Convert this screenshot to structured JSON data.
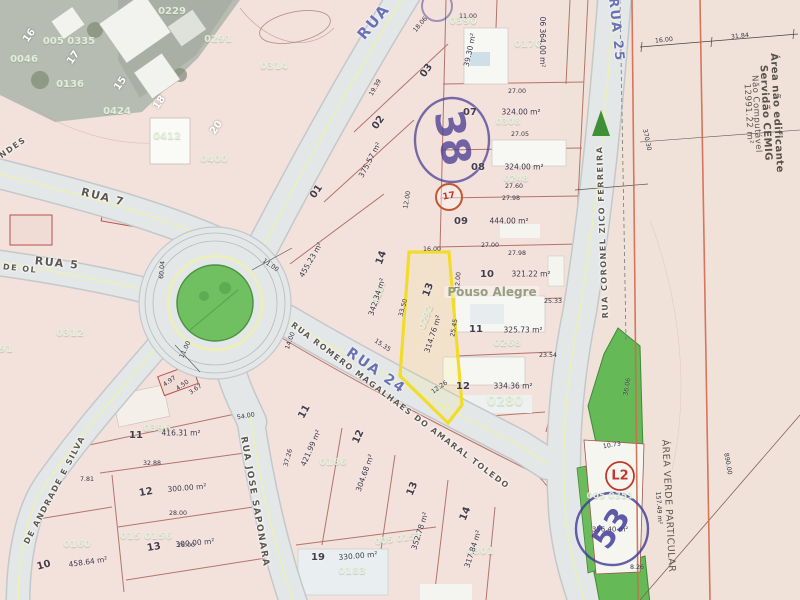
{
  "map": {
    "highlighted_lot": "13",
    "highlighted_lot_area": "314.76 m²",
    "colors": {
      "parcel_pink": "#f3e1dc",
      "street_gray": "#e4e7e8",
      "green_area": "#6cbb5d",
      "boundary_red": "#a25a50",
      "highlight_yellow": "#f2dc2a",
      "stamp_purple": "#4b3f94",
      "stamp_red": "#c0392b",
      "cemig_line_orange": "#d4694f",
      "street_blue_label": "#6872b5"
    },
    "texts": [
      {
        "n": "street-label-rua",
        "t": "RUA",
        "x": 374,
        "y": 22,
        "r": -50,
        "c": "bluestreet",
        "s": 15
      },
      {
        "n": "street-label-rua-7",
        "t": "RUA 7",
        "x": 103,
        "y": 197,
        "r": 14,
        "c": "street",
        "s": 11
      },
      {
        "n": "street-label-rua-5",
        "t": "RUA 5",
        "x": 57,
        "y": 263,
        "r": 6,
        "c": "street",
        "s": 11
      },
      {
        "n": "street-label-de-ol",
        "t": "DE OL",
        "x": 20,
        "y": 269,
        "r": 6,
        "c": "street",
        "s": 8
      },
      {
        "n": "street-label-rua-24",
        "t": "RUA 24",
        "x": 376,
        "y": 371,
        "r": 35,
        "c": "bluestreet",
        "s": 14
      },
      {
        "n": "street-label-romero-magalhaes",
        "t": "RUA ROMERO MAGALHAES DO AMARAL TOLEDO",
        "x": 400,
        "y": 406,
        "r": 37,
        "c": "street",
        "s": 8
      },
      {
        "n": "street-label-jose-saponara",
        "t": "RUA JOSE SAPONARA",
        "x": 254,
        "y": 502,
        "r": 80,
        "c": "street",
        "s": 9
      },
      {
        "n": "street-label-rua-25",
        "t": "RUA 25",
        "x": 616,
        "y": 30,
        "r": 84,
        "c": "bluestreet",
        "s": 13
      },
      {
        "n": "street-label-zico-ferreira",
        "t": "RUA CORONEL ZICO FERREIRA",
        "x": 603,
        "y": 232,
        "r": -92,
        "c": "street",
        "s": 8
      },
      {
        "n": "street-label-andrade-silva",
        "t": "DE ANDRADE E SILVA",
        "x": 55,
        "y": 490,
        "r": -62,
        "c": "street",
        "s": 8
      },
      {
        "n": "street-label-ndes",
        "t": "NDES",
        "x": 13,
        "y": 148,
        "r": -35,
        "c": "street",
        "s": 8
      },
      {
        "n": "cemig-note-line1",
        "t": "Área não edificante",
        "x": 776,
        "y": 113,
        "r": 87,
        "c": "cemig",
        "s": 10
      },
      {
        "n": "cemig-note-line2",
        "t": "Servidão CEMIG",
        "x": 765,
        "y": 113,
        "r": 87,
        "c": "cemig",
        "s": 10
      },
      {
        "n": "cemig-note-line3",
        "t": "Não Computável",
        "x": 756,
        "y": 114,
        "r": 87,
        "c": "cemig2"
      },
      {
        "n": "cemig-note-area",
        "t": "12991.22 m²",
        "x": 748,
        "y": 114,
        "r": 87,
        "c": "cemig2"
      },
      {
        "n": "area-verde-label",
        "t": "ÁREA VERDE PARTICULAR",
        "x": 668,
        "y": 506,
        "r": 87,
        "c": "cemig2",
        "s": 9.5
      },
      {
        "t": "16",
        "x": 30,
        "y": 36,
        "r": -55,
        "c": "wlot"
      },
      {
        "t": "17",
        "x": 74,
        "y": 58,
        "r": -55,
        "c": "wlot"
      },
      {
        "t": "15",
        "x": 121,
        "y": 84,
        "r": -55,
        "c": "wlot"
      },
      {
        "t": "18",
        "x": 160,
        "y": 103,
        "r": -55,
        "c": "wlot"
      },
      {
        "t": "20",
        "x": 217,
        "y": 128,
        "r": -55,
        "c": "wlot"
      },
      {
        "t": "0046",
        "x": 24,
        "y": 60,
        "c": "wm"
      },
      {
        "t": "005 0335",
        "x": 69,
        "y": 42,
        "c": "wm"
      },
      {
        "t": "0229",
        "x": 172,
        "y": 12,
        "c": "wm"
      },
      {
        "t": "0291",
        "x": 218,
        "y": 40,
        "c": "wm"
      },
      {
        "t": "0136",
        "x": 70,
        "y": 85,
        "c": "wm"
      },
      {
        "t": "0424",
        "x": 117,
        "y": 112,
        "c": "wm"
      },
      {
        "t": "0412",
        "x": 167,
        "y": 137,
        "c": "wm"
      },
      {
        "t": "0400",
        "x": 214,
        "y": 160,
        "c": "wm"
      },
      {
        "t": "0314",
        "x": 274,
        "y": 67,
        "c": "wm"
      },
      {
        "t": "0312",
        "x": 70,
        "y": 334,
        "c": "wm"
      },
      {
        "t": "91",
        "x": 6,
        "y": 350,
        "c": "wm"
      },
      {
        "t": "0390",
        "x": 463,
        "y": 22,
        "c": "wm"
      },
      {
        "t": "0170",
        "x": 528,
        "y": 45,
        "c": "wm"
      },
      {
        "t": "0308",
        "x": 508,
        "y": 123,
        "c": "wm",
        "s": 9
      },
      {
        "t": "0248",
        "x": 516,
        "y": 180,
        "c": "wm",
        "s": 9
      },
      {
        "t": "0207",
        "x": 380,
        "y": 293,
        "r": -70,
        "c": "wm",
        "s": 9
      },
      {
        "t": "0292",
        "x": 427,
        "y": 318,
        "r": -70,
        "c": "wm",
        "s": 9
      },
      {
        "t": "0268",
        "x": 507,
        "y": 344,
        "c": "wm"
      },
      {
        "t": "0280",
        "x": 505,
        "y": 402,
        "c": "wmbig"
      },
      {
        "t": "0186",
        "x": 333,
        "y": 463,
        "c": "wm"
      },
      {
        "t": "015 0156",
        "x": 146,
        "y": 537,
        "c": "wm"
      },
      {
        "t": "0160",
        "x": 77,
        "y": 545,
        "c": "wm"
      },
      {
        "t": "0396",
        "x": 157,
        "y": 429,
        "c": "wm"
      },
      {
        "t": "0183",
        "x": 352,
        "y": 572,
        "c": "wm"
      },
      {
        "t": "0301",
        "x": 480,
        "y": 552,
        "c": "wm"
      },
      {
        "t": "005 0157",
        "x": 398,
        "y": 540,
        "r": -8,
        "c": "wm",
        "s": 9
      },
      {
        "t": "005 0351",
        "x": 610,
        "y": 497,
        "c": "wm",
        "s": 9
      },
      {
        "n": "neighborhood-label",
        "t": "Pouso Alegre",
        "x": 492,
        "y": 292,
        "c": "wmname"
      },
      {
        "t": "01",
        "x": 317,
        "y": 192,
        "r": -55,
        "c": "lot"
      },
      {
        "t": "455.23 m²",
        "x": 311,
        "y": 260,
        "r": -60,
        "c": "area"
      },
      {
        "t": "02",
        "x": 379,
        "y": 123,
        "r": -55,
        "c": "lot"
      },
      {
        "t": "375.57 m²",
        "x": 370,
        "y": 160,
        "r": -62,
        "c": "area"
      },
      {
        "t": "03",
        "x": 427,
        "y": 71,
        "r": -55,
        "c": "lot"
      },
      {
        "t": "39.30 m²",
        "x": 470,
        "y": 50,
        "r": -78,
        "c": "area"
      },
      {
        "t": "06 364.00 m²",
        "x": 542,
        "y": 42,
        "r": 90,
        "c": "area"
      },
      {
        "t": "07",
        "x": 470,
        "y": 113,
        "c": "lot"
      },
      {
        "t": "324.00 m²",
        "x": 521,
        "y": 112,
        "c": "area"
      },
      {
        "t": "08",
        "x": 478,
        "y": 168,
        "c": "lot"
      },
      {
        "t": "324.00 m²",
        "x": 524,
        "y": 167,
        "c": "area"
      },
      {
        "t": "09",
        "x": 461,
        "y": 222,
        "c": "lot"
      },
      {
        "t": "444.00 m²",
        "x": 509,
        "y": 221,
        "c": "area"
      },
      {
        "t": "14",
        "x": 382,
        "y": 258,
        "r": -70,
        "c": "lot"
      },
      {
        "t": "342.34 m²",
        "x": 377,
        "y": 297,
        "r": -72,
        "c": "area"
      },
      {
        "n": "highlighted-lot-number",
        "t": "13",
        "x": 429,
        "y": 290,
        "r": -70,
        "c": "lot"
      },
      {
        "n": "highlighted-lot-area",
        "t": "314.76 m²",
        "x": 433,
        "y": 334,
        "r": -72,
        "c": "area"
      },
      {
        "t": "10",
        "x": 487,
        "y": 275,
        "c": "lot"
      },
      {
        "t": "321.22 m²",
        "x": 531,
        "y": 274,
        "c": "area"
      },
      {
        "t": "11",
        "x": 476,
        "y": 330,
        "c": "lot"
      },
      {
        "t": "325.73 m²",
        "x": 523,
        "y": 330,
        "c": "area"
      },
      {
        "t": "12",
        "x": 463,
        "y": 387,
        "c": "lot"
      },
      {
        "t": "334.36 m²",
        "x": 513,
        "y": 386,
        "c": "area"
      },
      {
        "t": "11",
        "x": 136,
        "y": 436,
        "c": "lot"
      },
      {
        "t": "416.31 m²",
        "x": 181,
        "y": 433,
        "c": "area"
      },
      {
        "t": "12",
        "x": 146,
        "y": 493,
        "r": -10,
        "c": "lot"
      },
      {
        "t": "300.00 m²",
        "x": 187,
        "y": 488,
        "r": -5,
        "c": "area"
      },
      {
        "t": "13",
        "x": 154,
        "y": 548,
        "r": -10,
        "c": "lot"
      },
      {
        "t": "300.00 m²",
        "x": 195,
        "y": 543,
        "r": -5,
        "c": "area"
      },
      {
        "t": "10",
        "x": 44,
        "y": 566,
        "r": -15,
        "c": "lot"
      },
      {
        "t": "458.64 m²",
        "x": 88,
        "y": 562,
        "r": -8,
        "c": "area"
      },
      {
        "t": "11",
        "x": 305,
        "y": 412,
        "r": -62,
        "c": "lot"
      },
      {
        "t": "421.99 m²",
        "x": 311,
        "y": 448,
        "r": -66,
        "c": "area"
      },
      {
        "t": "12",
        "x": 359,
        "y": 437,
        "r": -66,
        "c": "lot"
      },
      {
        "t": "304.68 m²",
        "x": 365,
        "y": 473,
        "r": -70,
        "c": "area"
      },
      {
        "t": "13",
        "x": 413,
        "y": 489,
        "r": -68,
        "c": "lot"
      },
      {
        "t": "352.78 m²",
        "x": 420,
        "y": 531,
        "r": -72,
        "c": "area"
      },
      {
        "t": "14",
        "x": 466,
        "y": 514,
        "r": -68,
        "c": "lot"
      },
      {
        "t": "317.84 m²",
        "x": 473,
        "y": 549,
        "r": -72,
        "c": "area"
      },
      {
        "t": "19",
        "x": 318,
        "y": 558,
        "c": "lot"
      },
      {
        "t": "330.00 m²",
        "x": 358,
        "y": 556,
        "r": -5,
        "c": "area"
      },
      {
        "t": "356.40 m²",
        "x": 610,
        "y": 530,
        "c": "area",
        "s": 7
      },
      {
        "t": "11.00",
        "x": 468,
        "y": 17,
        "c": "dim"
      },
      {
        "t": "27.00",
        "x": 517,
        "y": 92,
        "c": "dim"
      },
      {
        "t": "27.05",
        "x": 520,
        "y": 135,
        "c": "dim"
      },
      {
        "t": "27.60",
        "x": 514,
        "y": 187,
        "c": "dim"
      },
      {
        "t": "27.98",
        "x": 511,
        "y": 199,
        "c": "dim"
      },
      {
        "t": "12.00",
        "x": 408,
        "y": 200,
        "r": -80,
        "c": "dim"
      },
      {
        "t": "16.00",
        "x": 432,
        "y": 250,
        "c": "dim"
      },
      {
        "t": "27.00",
        "x": 490,
        "y": 246,
        "c": "dim"
      },
      {
        "t": "27.98",
        "x": 517,
        "y": 254,
        "c": "dim"
      },
      {
        "t": "25.33",
        "x": 553,
        "y": 302,
        "c": "dim"
      },
      {
        "t": "23.54",
        "x": 548,
        "y": 356,
        "c": "dim"
      },
      {
        "t": "12.00",
        "x": 459,
        "y": 281,
        "r": -85,
        "c": "dim"
      },
      {
        "t": "33.50",
        "x": 404,
        "y": 308,
        "r": -75,
        "c": "dim"
      },
      {
        "t": "25.45",
        "x": 455,
        "y": 328,
        "r": -80,
        "c": "dim"
      },
      {
        "t": "12.26",
        "x": 440,
        "y": 388,
        "r": -35,
        "c": "dim"
      },
      {
        "t": "11.00",
        "x": 270,
        "y": 266,
        "r": 35,
        "c": "dim"
      },
      {
        "t": "11.00",
        "x": 186,
        "y": 350,
        "r": -65,
        "c": "dim"
      },
      {
        "t": "60.04",
        "x": 163,
        "y": 270,
        "r": -85,
        "c": "dim"
      },
      {
        "t": "4.97",
        "x": 170,
        "y": 382,
        "r": -35,
        "c": "dim"
      },
      {
        "t": "4.50",
        "x": 183,
        "y": 386,
        "r": -35,
        "c": "dim"
      },
      {
        "t": "3.67",
        "x": 196,
        "y": 390,
        "r": -35,
        "c": "dim"
      },
      {
        "t": "14.00",
        "x": 291,
        "y": 341,
        "r": -70,
        "c": "dim"
      },
      {
        "t": "15.35",
        "x": 382,
        "y": 346,
        "r": 33,
        "c": "dim"
      },
      {
        "t": "18.06",
        "x": 421,
        "y": 25,
        "r": -50,
        "c": "dim"
      },
      {
        "t": "19.39",
        "x": 376,
        "y": 88,
        "r": -60,
        "c": "dim"
      },
      {
        "t": "32.88",
        "x": 152,
        "y": 464,
        "c": "dim"
      },
      {
        "t": "28.00",
        "x": 178,
        "y": 514,
        "c": "dim"
      },
      {
        "t": "28.00",
        "x": 186,
        "y": 546,
        "c": "dim"
      },
      {
        "t": "54.00",
        "x": 246,
        "y": 417,
        "r": -10,
        "c": "dim"
      },
      {
        "t": "37.26",
        "x": 289,
        "y": 458,
        "r": -75,
        "c": "dim"
      },
      {
        "t": "7.81",
        "x": 87,
        "y": 480,
        "c": "dim"
      },
      {
        "t": "16.00",
        "x": 664,
        "y": 41,
        "r": -6,
        "c": "dim"
      },
      {
        "t": "31.84",
        "x": 740,
        "y": 37,
        "r": -6,
        "c": "dim"
      },
      {
        "t": "370.30",
        "x": 646,
        "y": 140,
        "r": 78,
        "c": "dim"
      },
      {
        "t": "890.00",
        "x": 727,
        "y": 464,
        "r": 80,
        "c": "dim"
      },
      {
        "t": "157.49 m²",
        "x": 658,
        "y": 508,
        "r": 86,
        "c": "dim"
      },
      {
        "t": "10.73",
        "x": 612,
        "y": 446,
        "r": -10,
        "c": "dim"
      },
      {
        "t": "8.26",
        "x": 637,
        "y": 568,
        "c": "dim"
      },
      {
        "t": "36.06",
        "x": 628,
        "y": 387,
        "r": -80,
        "c": "dim"
      },
      {
        "n": "stamp-38",
        "t": "38",
        "x": 452,
        "y": 138,
        "r": 80,
        "c": "stampbig"
      },
      {
        "n": "stamp-53",
        "t": "53",
        "x": 612,
        "y": 529,
        "r": -55,
        "c": "stampbig2"
      },
      {
        "n": "stamp-l2",
        "t": "L2",
        "x": 620,
        "y": 476,
        "c": "stampL2"
      },
      {
        "n": "stamp-17",
        "t": "17",
        "x": 449,
        "y": 197,
        "r": -10,
        "c": "stamp17"
      }
    ]
  }
}
